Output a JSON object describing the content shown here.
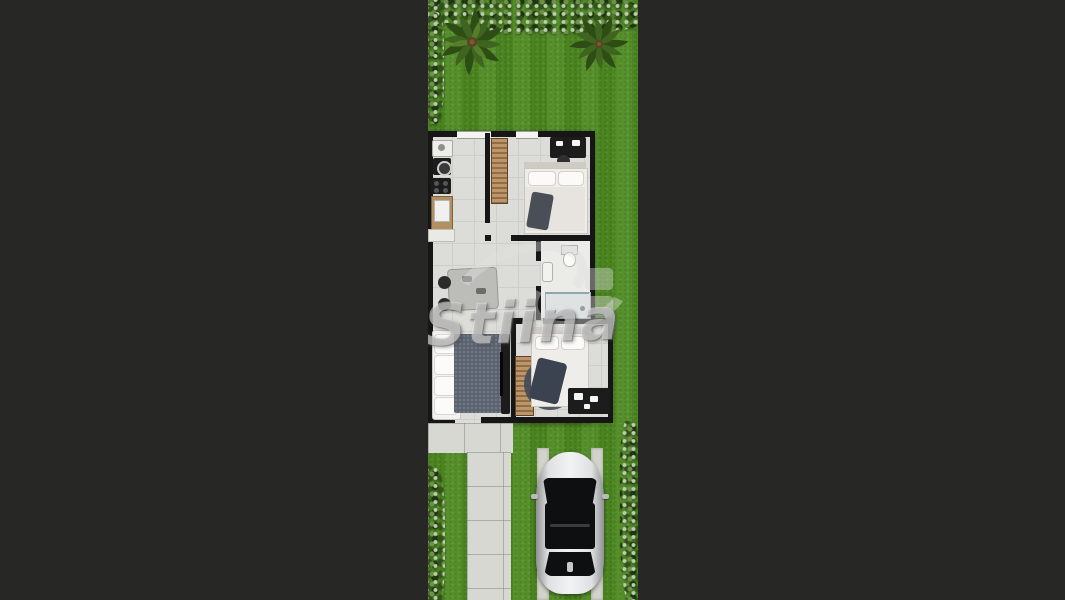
{
  "scene": {
    "type": "top-down 2D architectural floor plan render of a narrow lot house",
    "watermark_text": "Stiina",
    "colors": {
      "page_background": "#272825",
      "grass": "#4f8c22",
      "hedge_dark": "#1d3510",
      "hedge_light": "#b9cfa8",
      "walls": "#161616",
      "floor_tile": "#dcdcd8",
      "concrete": "#d8d8d3",
      "wood_counter": "#b3905f",
      "car_silver": "#dfe0e2",
      "rug_slate": "#5a6270"
    },
    "objects": {
      "vegetation": [
        "top-hedge",
        "left-hedge-upper",
        "left-hedge-lower",
        "right-hedge-lower",
        "palm-tree-left",
        "palm-tree-right"
      ],
      "rooms": [
        "kitchen",
        "bedroom-1",
        "bathroom",
        "dining-hall",
        "living-room",
        "bedroom-2"
      ],
      "furniture": [
        "kitchen-sink",
        "washing-machine",
        "cooktop",
        "wood-counter-fridge",
        "wardrobe-bedroom-1",
        "double-bed-1",
        "desk-bedroom-1",
        "toilet",
        "shower",
        "dining-table",
        "dining-chairs",
        "sofa",
        "living-rug",
        "tv-console",
        "wardrobe-bedroom-2",
        "double-bed-2",
        "round-rug",
        "desk-bedroom-2"
      ],
      "exterior": [
        "patio-slab",
        "front-walkway",
        "driveway-strips",
        "silver-sedan-car"
      ]
    }
  }
}
